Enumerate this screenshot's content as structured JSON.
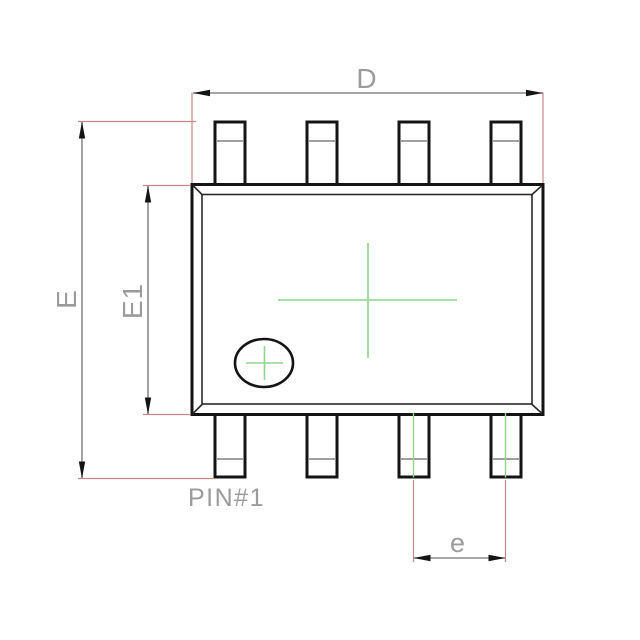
{
  "drawing": {
    "kind": "ic-package-dimension-drawing",
    "view": "top",
    "pin_count": 8,
    "pins_top": 4,
    "pins_bottom": 4
  },
  "labels": {
    "overall_width": "D",
    "overall_height": "E",
    "body_height": "E1",
    "pin_pitch": "e",
    "pin1": "PIN#1"
  },
  "colors": {
    "background": "#ffffff",
    "outline": "#141414",
    "inner-line": "#2a2a2a",
    "bend-line": "#666666",
    "dim-line": "#707070",
    "ext-line": "#d08585",
    "center-line": "#8fd68f",
    "label-text": "#9b9b9b",
    "arrow": "#141414"
  }
}
